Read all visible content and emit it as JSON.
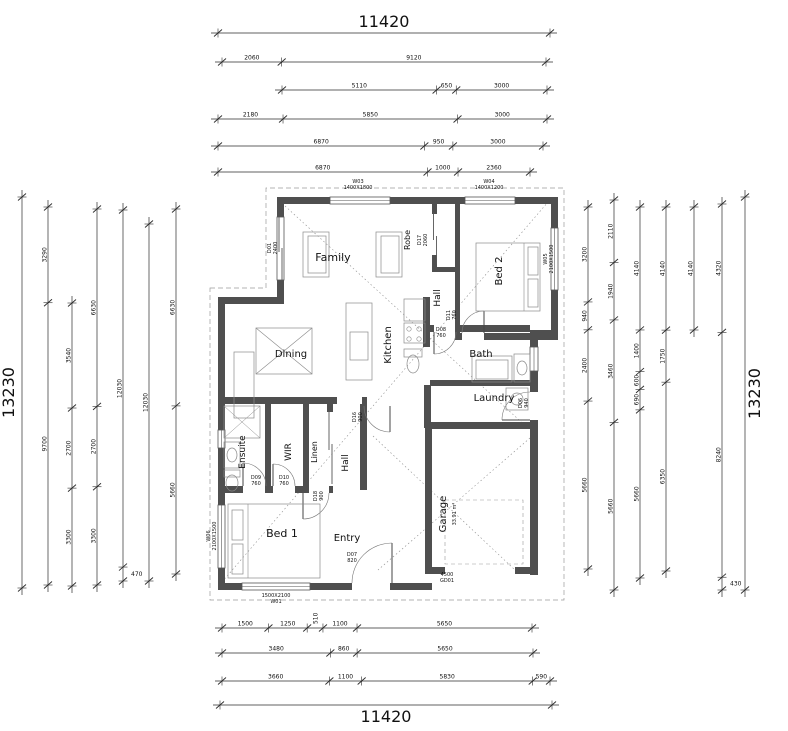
{
  "drawing_title": "Residential floor plan with dimension chains",
  "colors": {
    "wall": "#4f4f4f",
    "dim_line": "#2b2b2b",
    "text": "#111111",
    "furniture": "#8a8a8a",
    "dashed": "#9a9a9a"
  },
  "overall": {
    "top": "11420",
    "bottom": "11420",
    "left": "13230",
    "right": "13230"
  },
  "h_chains": [
    {
      "y": 33,
      "from": 218,
      "to": 550,
      "segments": [
        11420
      ],
      "big": true
    },
    {
      "y": 62,
      "from": 222,
      "to": 546,
      "segments": [
        2060,
        9120
      ]
    },
    {
      "y": 90,
      "from": 282,
      "to": 547,
      "segments": [
        5110,
        650,
        3000
      ]
    },
    {
      "y": 119,
      "from": 218,
      "to": 547,
      "segments": [
        2180,
        5850,
        3000
      ]
    },
    {
      "y": 146,
      "from": 218,
      "to": 543,
      "segments": [
        6870,
        950,
        3000
      ]
    },
    {
      "y": 172,
      "from": 218,
      "to": 530,
      "segments": [
        6870,
        1000,
        2360
      ]
    },
    {
      "y": 628,
      "from": 222,
      "to": 532,
      "segments": [
        1500,
        1250,
        510,
        1100,
        5650
      ]
    },
    {
      "y": 653,
      "from": 222,
      "to": 533,
      "segments": [
        3480,
        860,
        5650
      ]
    },
    {
      "y": 681,
      "from": 222,
      "to": 550,
      "segments": [
        3660,
        1100,
        5830,
        590
      ]
    },
    {
      "y": 705,
      "from": 220,
      "to": 552,
      "segments": [
        11420
      ],
      "big": true,
      "below": true
    }
  ],
  "v_chains": [
    {
      "x": 22,
      "from": 197,
      "to": 588,
      "segments": [
        13230
      ],
      "big": true
    },
    {
      "x": 48,
      "from": 207,
      "to": 585,
      "segments": [
        3290,
        9700
      ]
    },
    {
      "x": 72,
      "from": 303,
      "to": 586,
      "segments": [
        3540,
        2700,
        3300
      ]
    },
    {
      "x": 97,
      "from": 209,
      "to": 585,
      "segments": [
        6630,
        2700,
        3300
      ]
    },
    {
      "x": 123,
      "from": 210,
      "to": 581,
      "segments": [
        12030,
        470
      ]
    },
    {
      "x": 149,
      "from": 224,
      "to": 581,
      "segments": [
        12030
      ]
    },
    {
      "x": 176,
      "from": 209,
      "to": 574,
      "segments": [
        6630,
        5660
      ]
    },
    {
      "x": 588,
      "from": 207,
      "to": 569,
      "segments": [
        3200,
        940,
        2400,
        5660
      ]
    },
    {
      "x": 614,
      "from": 200,
      "to": 590,
      "segments": [
        2110,
        1940,
        3460,
        5660
      ]
    },
    {
      "x": 640,
      "from": 207,
      "to": 578,
      "segments": [
        4140,
        1400,
        600,
        690,
        5660
      ]
    },
    {
      "x": 666,
      "from": 207,
      "to": 571,
      "segments": [
        4140,
        1750,
        6350
      ]
    },
    {
      "x": 694,
      "from": 207,
      "to": 330,
      "segments": [
        4140
      ]
    },
    {
      "x": 722,
      "from": 204,
      "to": 590,
      "segments": [
        4320,
        8240,
        430
      ]
    },
    {
      "x": 745,
      "from": 197,
      "to": 590,
      "segments": [
        13230
      ],
      "big": true,
      "right": true
    }
  ],
  "rooms": [
    {
      "t": "Family",
      "x": 333,
      "y": 261,
      "fs": 11,
      "r": 0
    },
    {
      "t": "Dining",
      "x": 291,
      "y": 357,
      "fs": 10,
      "r": 0
    },
    {
      "t": "Kitchen",
      "x": 391,
      "y": 345,
      "fs": 10,
      "r": -90
    },
    {
      "t": "Hall",
      "x": 440,
      "y": 298,
      "fs": 9,
      "r": -90
    },
    {
      "t": "Bed 2",
      "x": 502,
      "y": 271,
      "fs": 10,
      "r": -90
    },
    {
      "t": "Bath",
      "x": 481,
      "y": 357,
      "fs": 10,
      "r": 0
    },
    {
      "t": "Laundry",
      "x": 494,
      "y": 401,
      "fs": 10,
      "r": 0
    },
    {
      "t": "Ensuite",
      "x": 245,
      "y": 452,
      "fs": 9,
      "r": -90
    },
    {
      "t": "WIR",
      "x": 291,
      "y": 452,
      "fs": 9,
      "r": -90
    },
    {
      "t": "Linen",
      "x": 317,
      "y": 452,
      "fs": 8,
      "r": -90
    },
    {
      "t": "Hall",
      "x": 348,
      "y": 463,
      "fs": 9,
      "r": -90
    },
    {
      "t": "Bed 1",
      "x": 282,
      "y": 537,
      "fs": 11,
      "r": 0
    },
    {
      "t": "Entry",
      "x": 347,
      "y": 541,
      "fs": 10,
      "r": 0
    },
    {
      "t": "Garage",
      "x": 446,
      "y": 514,
      "fs": 10,
      "r": -90
    },
    {
      "t": "33.91 m²",
      "x": 456,
      "y": 514,
      "fs": 5,
      "r": -90
    }
  ],
  "annotations": [
    {
      "l": [
        "W03",
        "1400X1800"
      ],
      "x": 358,
      "y": 183,
      "r": 0
    },
    {
      "l": [
        "W04",
        "1400X1200"
      ],
      "x": 489,
      "y": 183,
      "r": 0
    },
    {
      "l": [
        "1500X2100",
        "W01"
      ],
      "x": 276,
      "y": 597,
      "r": 0
    },
    {
      "l": [
        "W06",
        "2100X1500"
      ],
      "x": 210,
      "y": 536,
      "r": -90
    },
    {
      "l": [
        "W05",
        "2100X1500"
      ],
      "x": 547,
      "y": 259,
      "r": -90
    },
    {
      "l": [
        "D01",
        "2400"
      ],
      "x": 271,
      "y": 248,
      "r": -90
    },
    {
      "l": [
        "Robe"
      ],
      "x": 410,
      "y": 240,
      "r": -90,
      "fs": 8
    },
    {
      "l": [
        "D17",
        "2060"
      ],
      "x": 421,
      "y": 240,
      "r": -90
    },
    {
      "l": [
        "D11",
        "760"
      ],
      "x": 450,
      "y": 315,
      "r": -90
    },
    {
      "l": [
        "D08",
        "760"
      ],
      "x": 441,
      "y": 331,
      "r": 0
    },
    {
      "l": [
        "D16",
        "900"
      ],
      "x": 356,
      "y": 417,
      "r": -90
    },
    {
      "l": [
        "D18",
        "900"
      ],
      "x": 317,
      "y": 496,
      "r": -90
    },
    {
      "l": [
        "D09",
        "760"
      ],
      "x": 256,
      "y": 479,
      "r": 0
    },
    {
      "l": [
        "D10",
        "760"
      ],
      "x": 284,
      "y": 479,
      "r": 0
    },
    {
      "l": [
        "D07",
        "820"
      ],
      "x": 352,
      "y": 556,
      "r": 0
    },
    {
      "l": [
        "D06",
        "940"
      ],
      "x": 522,
      "y": 403,
      "r": -90
    },
    {
      "l": [
        "4500",
        "GD01"
      ],
      "x": 447,
      "y": 576,
      "r": 0
    }
  ]
}
